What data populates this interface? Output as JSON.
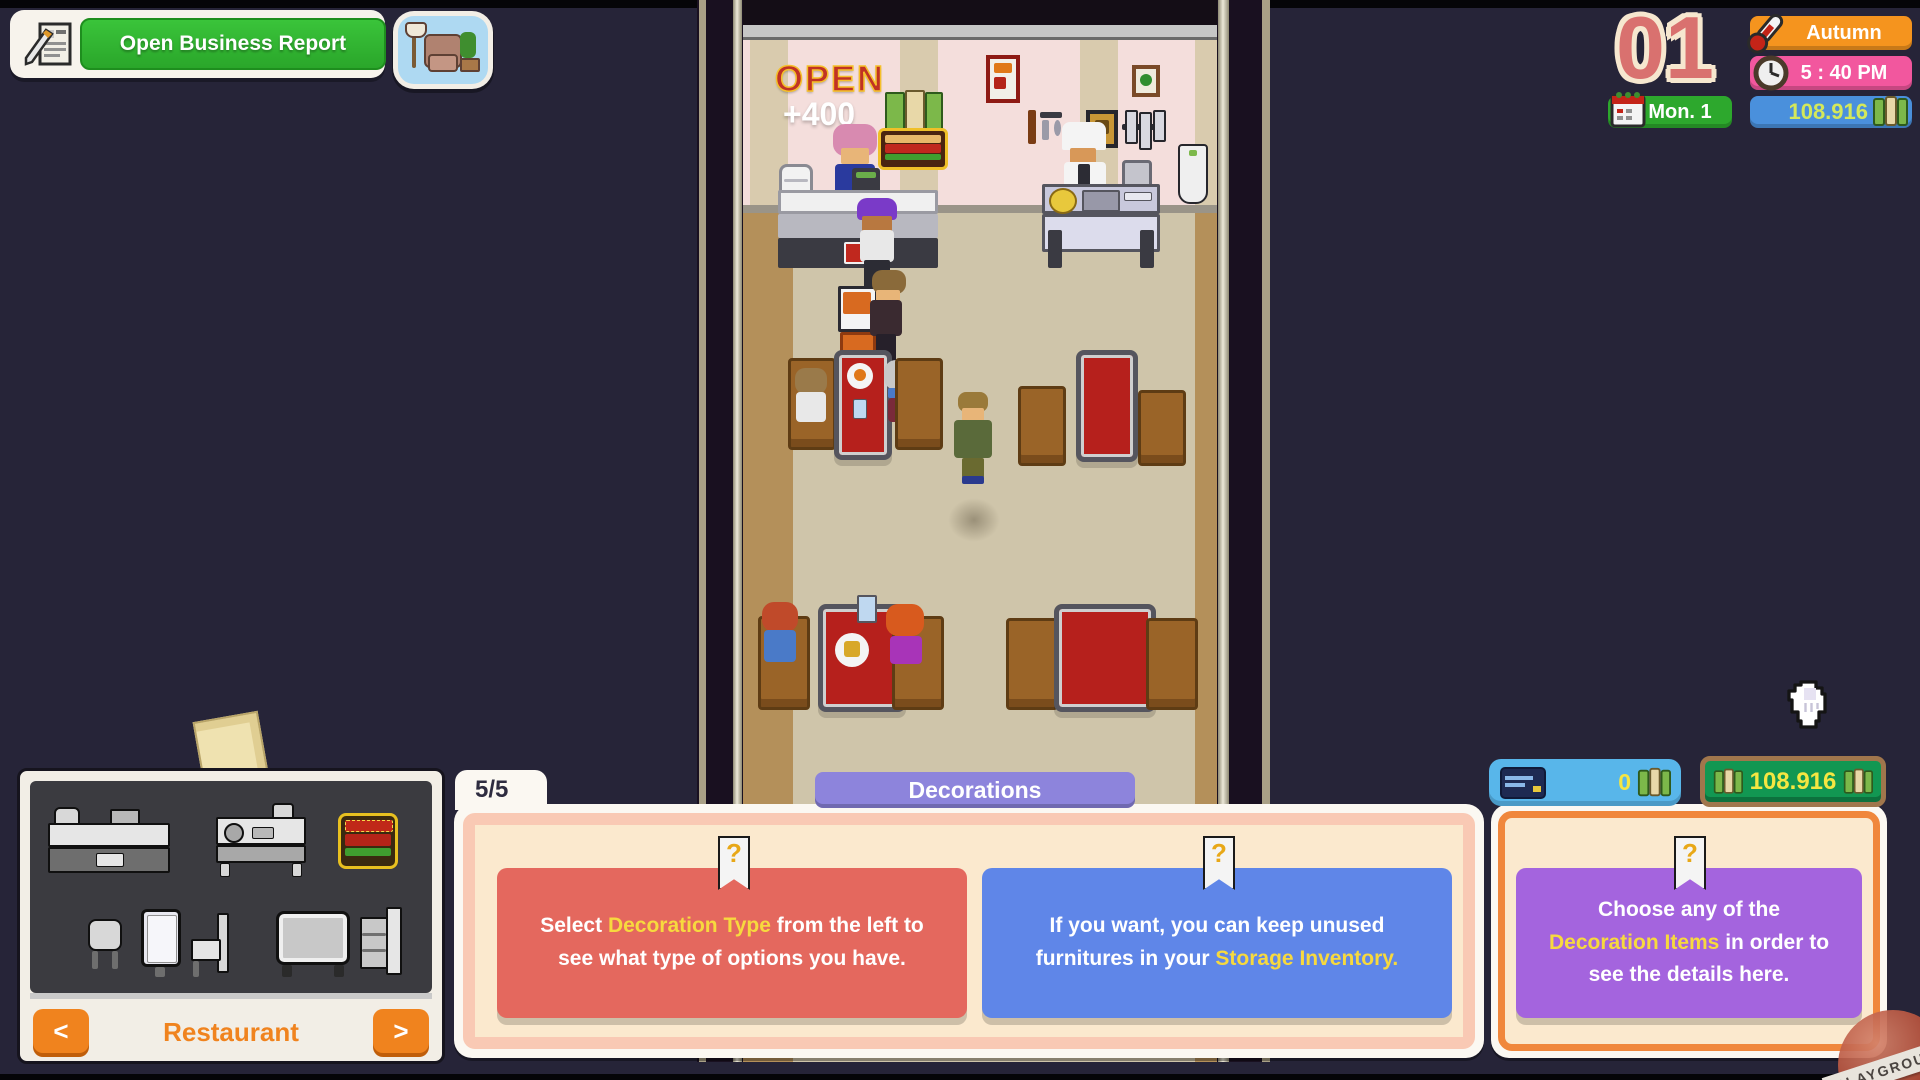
{
  "colors": {
    "background": "#262438",
    "accent_orange": "#F0831E",
    "panel_peach": "#FBE9CE",
    "card_red": "#E4685E",
    "card_blue": "#5F86E8",
    "card_purple": "#A464DE",
    "money_yellow": "#F5E642",
    "hud_orange": "#F5941E",
    "hud_pink": "#F2579E",
    "hud_green": "#2DA82D",
    "hud_blue": "#4A90DC",
    "report_green": "#2FB52F"
  },
  "top_left": {
    "report_button": "Open Business Report"
  },
  "hud": {
    "day_number": "01",
    "season": "Autumn",
    "time": "5 : 40 PM",
    "date": "Mon. 1",
    "money": "108.916"
  },
  "scene": {
    "open_sign": "OPEN",
    "earn_popup": "+400"
  },
  "left_panel": {
    "category": "Restaurant",
    "prev": "<",
    "next": ">"
  },
  "decor": {
    "tab_count": "5/5",
    "title": "Decorations"
  },
  "wallet": {
    "card_balance": "0",
    "cash": "108.916"
  },
  "cards": [
    {
      "before": "Select ",
      "highlight": "Decoration Type",
      "after": " from the left to see what type of options you have."
    },
    {
      "before": "If you want, you can keep unused furnitures in your ",
      "highlight": "Storage Inventory.",
      "after": ""
    },
    {
      "before": "Choose any of the ",
      "highlight": "Decoration Items",
      "after": " in order to see the details here."
    }
  ],
  "icons": {
    "question": "?"
  },
  "watermark": {
    "label": "PLAYGROUND"
  }
}
